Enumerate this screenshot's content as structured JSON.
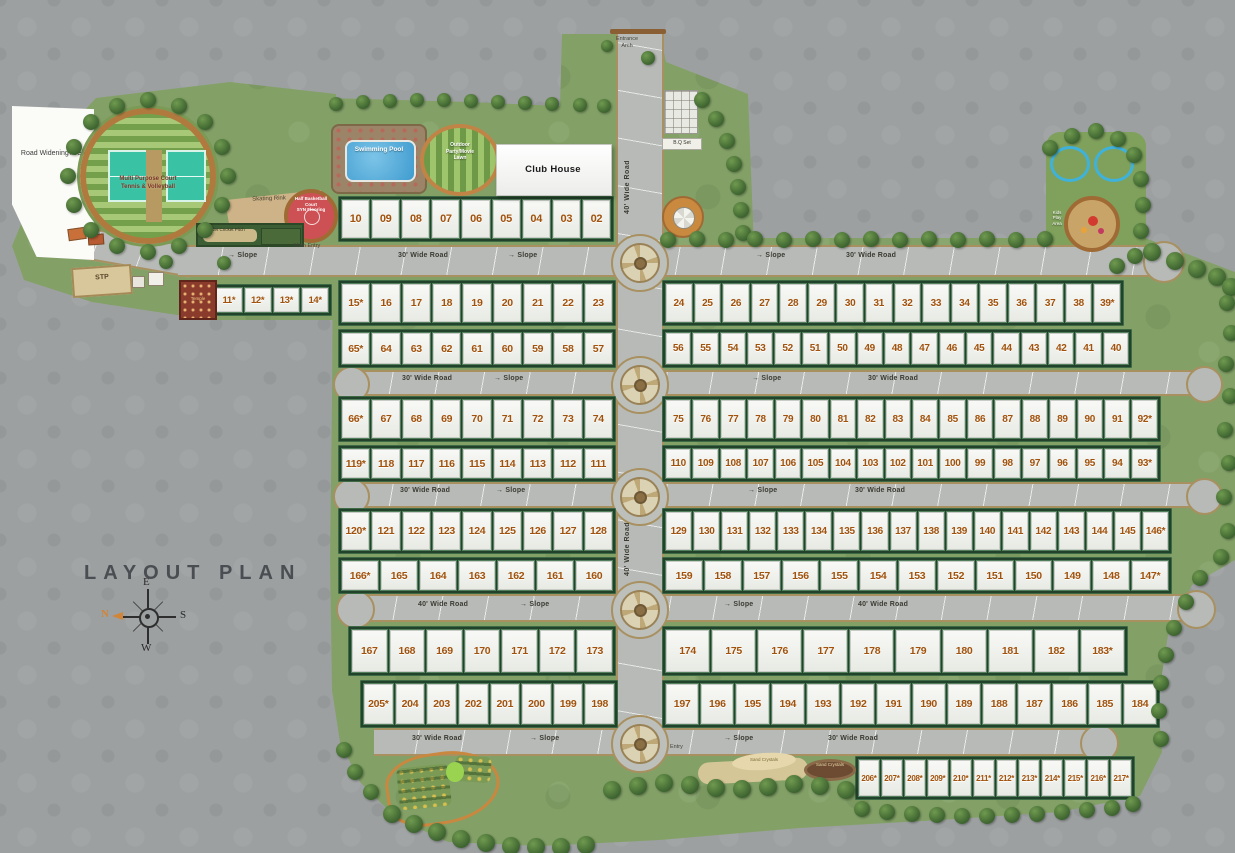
{
  "title": "LAYOUT PLAN",
  "compass": {
    "n": "N",
    "e": "E",
    "s": "S",
    "w": "W"
  },
  "labels": {
    "road_widening": "Road Widening Area",
    "mp_court_l1": "Multi Purpose Court",
    "mp_court_l2": "Tennis & Volleyball",
    "skating": "Skating Rink",
    "bball_l1": "Half Basketball",
    "bball_l2": "Court",
    "bball_l3": "SYN Flooring",
    "cricket": "Net Cricket Pitch",
    "stp": "STP",
    "temple": "Temple",
    "pool": "Swimming Pool",
    "lawn_l1": "Outdoor",
    "lawn_l2": "Party/Movie",
    "lawn_l3": "Lawn",
    "clubhouse": "Club House",
    "bq": "B.Q Set",
    "kids": "Kids Play Area",
    "sand_1": "Sand Crystals",
    "sand_2": "Sand Crystals"
  },
  "road_labels": [
    {
      "cls": "road",
      "arrow": true,
      "t": "Slope",
      "x": 228,
      "y": 252
    },
    {
      "cls": "road",
      "t": "30' Wide Road",
      "x": 398,
      "y": 252
    },
    {
      "cls": "road",
      "arrow": true,
      "t": "Slope",
      "x": 508,
      "y": 252
    },
    {
      "cls": "road",
      "arrow": true,
      "t": "Slope",
      "x": 756,
      "y": 252
    },
    {
      "cls": "road",
      "t": "30' Wide Road",
      "x": 846,
      "y": 252
    },
    {
      "cls": "road",
      "t": "30' Wide Road",
      "x": 402,
      "y": 375
    },
    {
      "cls": "road",
      "arrow": true,
      "t": "Slope",
      "x": 494,
      "y": 375
    },
    {
      "cls": "road",
      "arrow": true,
      "t": "Slope",
      "x": 752,
      "y": 375
    },
    {
      "cls": "road",
      "t": "30' Wide Road",
      "x": 868,
      "y": 375
    },
    {
      "cls": "road",
      "t": "30' Wide Road",
      "x": 400,
      "y": 487
    },
    {
      "cls": "road",
      "arrow": true,
      "t": "Slope",
      "x": 496,
      "y": 487
    },
    {
      "cls": "road",
      "arrow": true,
      "t": "Slope",
      "x": 748,
      "y": 487
    },
    {
      "cls": "road",
      "t": "30' Wide Road",
      "x": 855,
      "y": 487
    },
    {
      "cls": "road",
      "t": "40' Wide Road",
      "x": 418,
      "y": 601
    },
    {
      "cls": "road",
      "arrow": true,
      "t": "Slope",
      "x": 520,
      "y": 601
    },
    {
      "cls": "road",
      "arrow": true,
      "t": "Slope",
      "x": 724,
      "y": 601
    },
    {
      "cls": "road",
      "t": "40' Wide Road",
      "x": 858,
      "y": 601
    },
    {
      "cls": "road",
      "t": "30' Wide Road",
      "x": 412,
      "y": 735
    },
    {
      "cls": "road",
      "arrow": true,
      "t": "Slope",
      "x": 530,
      "y": 735
    },
    {
      "cls": "tinyn",
      "t": "Entry",
      "x": 670,
      "y": 744
    },
    {
      "cls": "road",
      "arrow": true,
      "t": "Slope",
      "x": 724,
      "y": 735
    },
    {
      "cls": "road",
      "t": "30' Wide Road",
      "x": 828,
      "y": 735
    },
    {
      "cls": "roadv",
      "t": "40' Wide Road",
      "x": 624,
      "y": 160
    },
    {
      "cls": "roadv",
      "t": "40' Wide Road",
      "x": 624,
      "y": 522
    },
    {
      "cls": "tinyn",
      "t": "Main Entry",
      "x": 294,
      "y": 243
    },
    {
      "cls": "tiny",
      "t": "Entrance Arch",
      "x": 610,
      "y": 36
    }
  ],
  "plot_blocks": [
    {
      "name": "plots-02-10",
      "x": 338,
      "y": 196,
      "w": 276,
      "h": 46,
      "fs": 11,
      "plots": [
        "10",
        "09",
        "08",
        "07",
        "06",
        "05",
        "04",
        "03",
        "02"
      ]
    },
    {
      "name": "plots-11-14",
      "x": 212,
      "y": 284,
      "w": 120,
      "h": 32,
      "fs": 9.5,
      "plots": [
        "11*",
        "12*",
        "13*",
        "14*"
      ]
    },
    {
      "name": "plots-15-23",
      "x": 338,
      "y": 280,
      "w": 278,
      "h": 46,
      "fs": 10.5,
      "plots": [
        "15*",
        "16",
        "17",
        "18",
        "19",
        "20",
        "21",
        "22",
        "23"
      ]
    },
    {
      "name": "plots-57-65",
      "x": 338,
      "y": 329,
      "w": 278,
      "h": 39,
      "fs": 10.5,
      "plots": [
        "65*",
        "64",
        "63",
        "62",
        "61",
        "60",
        "59",
        "58",
        "57"
      ]
    },
    {
      "name": "plots-24-39",
      "x": 662,
      "y": 280,
      "w": 462,
      "h": 46,
      "fs": 10,
      "plots": [
        "24",
        "25",
        "26",
        "27",
        "28",
        "29",
        "30",
        "31",
        "32",
        "33",
        "34",
        "35",
        "36",
        "37",
        "38",
        "39*"
      ]
    },
    {
      "name": "plots-40-56",
      "x": 662,
      "y": 329,
      "w": 470,
      "h": 39,
      "fs": 10,
      "plots": [
        "56",
        "55",
        "54",
        "53",
        "52",
        "51",
        "50",
        "49",
        "48",
        "47",
        "46",
        "45",
        "44",
        "43",
        "42",
        "41",
        "40"
      ]
    },
    {
      "name": "plots-66-74",
      "x": 338,
      "y": 396,
      "w": 278,
      "h": 46,
      "fs": 10.5,
      "plots": [
        "66*",
        "67",
        "68",
        "69",
        "70",
        "71",
        "72",
        "73",
        "74"
      ]
    },
    {
      "name": "plots-111-119",
      "x": 338,
      "y": 445,
      "w": 278,
      "h": 37,
      "fs": 10.5,
      "plots": [
        "119*",
        "118",
        "117",
        "116",
        "115",
        "114",
        "113",
        "112",
        "111"
      ]
    },
    {
      "name": "plots-75-92",
      "x": 662,
      "y": 396,
      "w": 499,
      "h": 46,
      "fs": 10,
      "plots": [
        "75",
        "76",
        "77",
        "78",
        "79",
        "80",
        "81",
        "82",
        "83",
        "84",
        "85",
        "86",
        "87",
        "88",
        "89",
        "90",
        "91",
        "92*"
      ]
    },
    {
      "name": "plots-93-110",
      "x": 662,
      "y": 445,
      "w": 499,
      "h": 37,
      "fs": 10,
      "plots": [
        "110",
        "109",
        "108",
        "107",
        "106",
        "105",
        "104",
        "103",
        "102",
        "101",
        "100",
        "99",
        "98",
        "97",
        "96",
        "95",
        "94",
        "93*"
      ]
    },
    {
      "name": "plots-120-128",
      "x": 338,
      "y": 508,
      "w": 278,
      "h": 46,
      "fs": 10.5,
      "plots": [
        "120*",
        "121",
        "122",
        "123",
        "124",
        "125",
        "126",
        "127",
        "128"
      ]
    },
    {
      "name": "plots-160-166",
      "x": 338,
      "y": 557,
      "w": 278,
      "h": 37,
      "fs": 10.5,
      "plots": [
        "166*",
        "165",
        "164",
        "163",
        "162",
        "161",
        "160"
      ]
    },
    {
      "name": "plots-129-146",
      "x": 662,
      "y": 508,
      "w": 510,
      "h": 46,
      "fs": 10,
      "plots": [
        "129",
        "130",
        "131",
        "132",
        "133",
        "134",
        "135",
        "136",
        "137",
        "138",
        "139",
        "140",
        "141",
        "142",
        "143",
        "144",
        "145",
        "146*"
      ]
    },
    {
      "name": "plots-147-159",
      "x": 662,
      "y": 557,
      "w": 510,
      "h": 37,
      "fs": 10.5,
      "plots": [
        "159",
        "158",
        "157",
        "156",
        "155",
        "154",
        "153",
        "152",
        "151",
        "150",
        "149",
        "148",
        "147*"
      ]
    },
    {
      "name": "plots-167-173",
      "x": 348,
      "y": 626,
      "w": 268,
      "h": 50,
      "fs": 10.5,
      "plots": [
        "167",
        "168",
        "169",
        "170",
        "171",
        "172",
        "173"
      ]
    },
    {
      "name": "plots-198-205",
      "x": 360,
      "y": 680,
      "w": 258,
      "h": 48,
      "fs": 10.5,
      "plots": [
        "205*",
        "204",
        "203",
        "202",
        "201",
        "200",
        "199",
        "198"
      ]
    },
    {
      "name": "plots-174-183",
      "x": 662,
      "y": 626,
      "w": 466,
      "h": 50,
      "fs": 10.5,
      "plots": [
        "174",
        "175",
        "176",
        "177",
        "178",
        "179",
        "180",
        "181",
        "182",
        "183*"
      ]
    },
    {
      "name": "plots-184-197",
      "x": 662,
      "y": 680,
      "w": 498,
      "h": 48,
      "fs": 10.5,
      "plots": [
        "197",
        "196",
        "195",
        "194",
        "193",
        "192",
        "191",
        "190",
        "189",
        "188",
        "187",
        "186",
        "185",
        "184"
      ]
    },
    {
      "name": "plots-206-217",
      "x": 855,
      "y": 756,
      "w": 280,
      "h": 44,
      "fs": 8,
      "plots": [
        "206*",
        "207*",
        "208*",
        "209*",
        "210*",
        "211*",
        "212*",
        "213*",
        "214*",
        "215*",
        "216*",
        "217*"
      ]
    }
  ],
  "colors": {
    "background_gray": "#9da0a1",
    "grass_green": "#83a167",
    "road_gray": "#b7bab6",
    "road_edge_tan": "#a89060",
    "plot_number": "#a1520c",
    "plot_strip_green": "#22422b",
    "basketball_red": "#cd5154",
    "pool_blue": "#3f9ccf",
    "compass_north_orange": "#d08538"
  }
}
